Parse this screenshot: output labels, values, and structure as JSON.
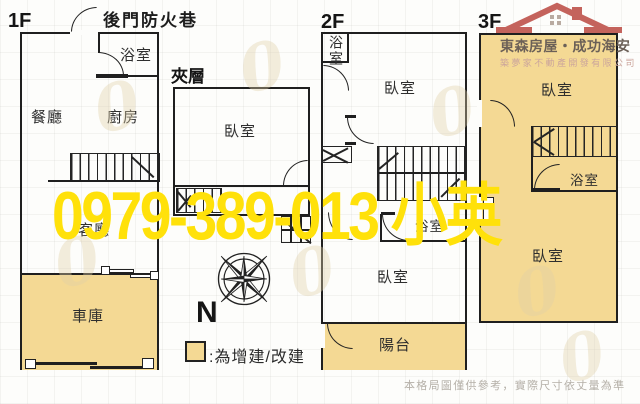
{
  "page": {
    "back_alley": "後門防火巷",
    "north": "N",
    "legend_text": ":為增建/改建",
    "watermark": "0979-389-013 小英",
    "disclaimer": "本格局圖僅供參考，實際尺寸依丈量為準"
  },
  "brand": {
    "title": "東森房屋・成功海安",
    "subtitle": "築夢家不動產開發有限公司"
  },
  "floors": {
    "f1": {
      "label": "1F",
      "bath": "浴室",
      "dining": "餐廳",
      "kitchen": "廚房",
      "living": "客廳",
      "garage": "車庫"
    },
    "mezz": {
      "label": "夾層",
      "bedroom": "臥室"
    },
    "f2": {
      "label": "2F",
      "bath_top": "浴室",
      "bedroom_top": "臥室",
      "bath_mid": "浴室",
      "bedroom_bottom": "臥室",
      "balcony": "陽台"
    },
    "f3": {
      "label": "3F",
      "bedroom_top": "臥室",
      "bath": "浴室",
      "bedroom_bottom": "臥室"
    }
  },
  "colors": {
    "addition_fill": "#f4d994",
    "watermark_yellow": "#ffe10a",
    "logo_red": "#c4635c",
    "logo_text": "#6b6057",
    "logo_subtext": "#cba59c",
    "disclaimer_text": "#b5b0a8"
  }
}
